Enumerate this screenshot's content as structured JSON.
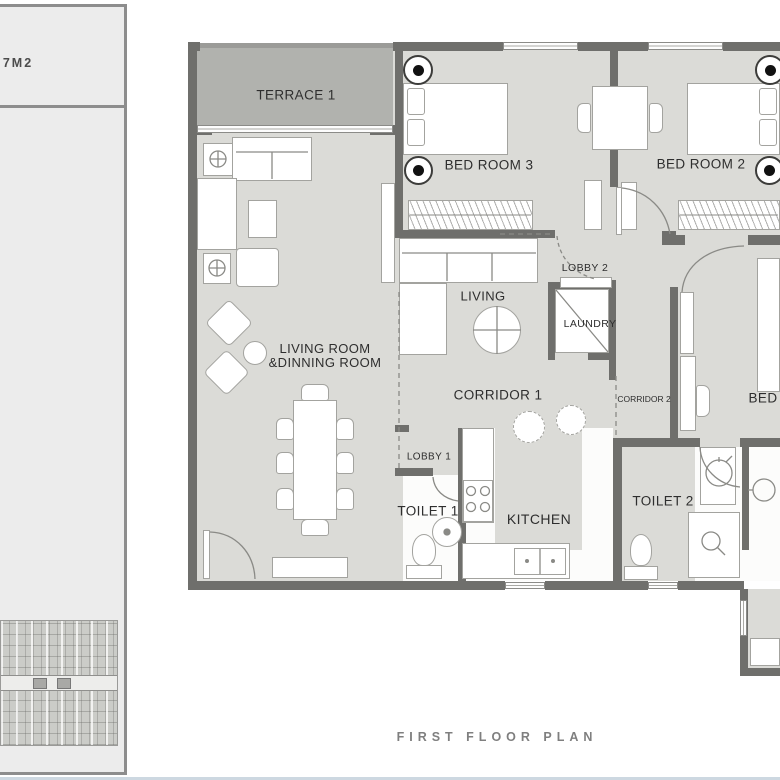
{
  "title": "FIRST FLOOR PLAN",
  "sidebar": {
    "area_label": "7M2"
  },
  "colors": {
    "wall": "#6f6f6c",
    "floor": "#dbdbd7",
    "terrace": "#b1b2ae",
    "furniture_outline": "#a3a39f",
    "label_text": "#2e2e2e",
    "title_text": "#7f7f7f",
    "sidebar_fill": "#ececec",
    "sidebar_border": "#8d8d8d",
    "bottom_strip": "#cdd8e1"
  },
  "rooms": {
    "terrace1": {
      "label": "TERRACE 1"
    },
    "bedroom3": {
      "label": "BED ROOM 3"
    },
    "bedroom2": {
      "label": "BED ROOM 2"
    },
    "living_dining": {
      "line1": "LIVING ROOM",
      "line2": "&DINNING ROOM"
    },
    "living": {
      "label": "LIVING"
    },
    "lobby2": {
      "label": "LOBBY 2"
    },
    "laundry": {
      "label": "LAUNDRY"
    },
    "corridor1": {
      "label": "CORRIDOR 1"
    },
    "corridor2": {
      "label": "CORRIDOR 2"
    },
    "bedroom1": {
      "label": "BED"
    },
    "lobby1": {
      "label": "LOBBY 1"
    },
    "toilet1": {
      "label": "TOILET 1"
    },
    "kitchen": {
      "label": "KITCHEN"
    },
    "toilet2": {
      "label": "TOILET 2"
    }
  }
}
